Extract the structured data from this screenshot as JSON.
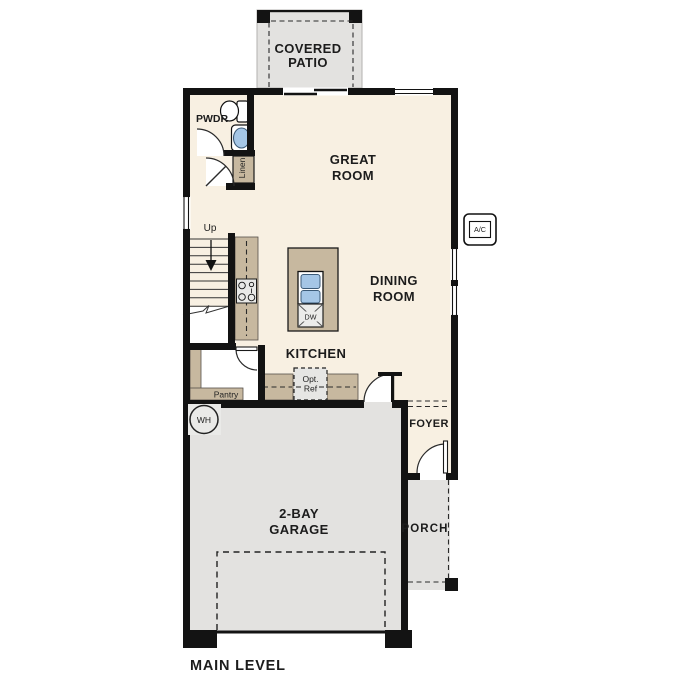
{
  "plan": {
    "title": "MAIN LEVEL",
    "labels": {
      "covered_patio_1": "COVERED",
      "covered_patio_2": "PATIO",
      "great_room_1": "GREAT",
      "great_room_2": "ROOM",
      "dining_1": "DINING",
      "dining_2": "ROOM",
      "kitchen": "KITCHEN",
      "pwdr": "PWDR",
      "linen": "Linen",
      "up": "Up",
      "pantry": "Pantry",
      "opt_ref_1": "Opt.",
      "opt_ref_2": "Ref",
      "dw": "DW",
      "wh": "WH",
      "ac": "A/C",
      "foyer": "FOYER",
      "porch": "PORCH",
      "garage_1": "2-BAY",
      "garage_2": "GARAGE"
    },
    "colors": {
      "floor_cream": "#f8f0e2",
      "concrete_gray": "#e3e2e0",
      "cabinet_tan": "#c7b89f",
      "wall_black": "#131313",
      "sink_blue": "#a5c6e6",
      "text_dark": "#1c1c1c"
    }
  }
}
